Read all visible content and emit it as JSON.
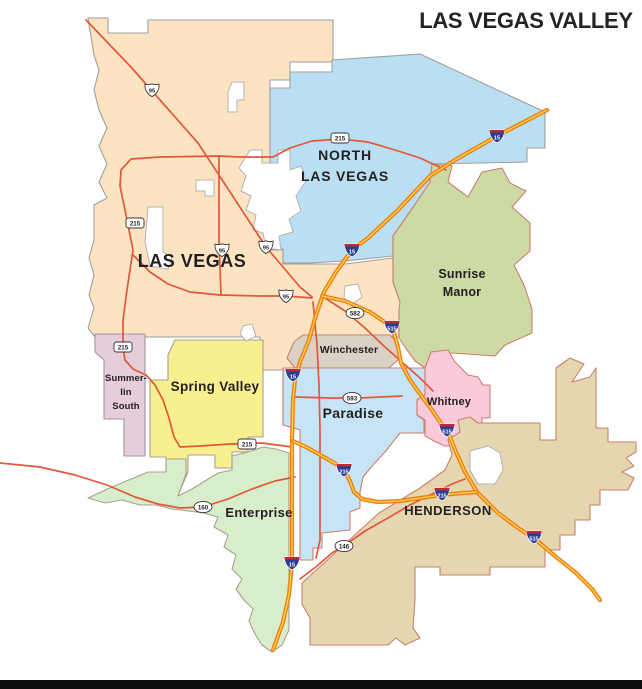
{
  "title": "LAS VEGAS VALLEY",
  "title_color": "#262223",
  "footer": {
    "bar_color": "#0d0d0d"
  },
  "map": {
    "background": "#ffffff",
    "colors": {
      "road": "#e2573b",
      "interstate_outer": "#ee7f1f",
      "interstate_center": "#ffd83c",
      "hole_fill": "#ffffff",
      "hole_stroke": "#b3b3b3",
      "shield_blue": "#2a3f92",
      "shield_red": "#bf2b32",
      "label": "#231f20"
    },
    "regions": [
      {
        "id": "las-vegas",
        "name": "Las Vegas",
        "fill": "#fce4c3",
        "stroke": "#9f9f9f",
        "shape": "88,18 108,18 108,33 148,33 148,20 333,20 333,62 290,62 290,80 270,80 270,250 283,250 283,264 345,264 393,258 393,282 400,302 417,308 417,337 300,337 300,370 260,370 260,337 95,337 88,328 94,308 89,295 94,275 89,258 94,240 94,205 107,198 99,182 107,164 99,146 107,128 99,110 94,90 99,70 94,55",
        "label": {
          "x": 192,
          "y": 267,
          "size": 18,
          "ls": 0.5,
          "lh": 20,
          "lines": [
            "LAS VEGAS"
          ]
        }
      },
      {
        "id": "north-las-vegas",
        "name": "North Las Vegas",
        "fill": "#badef2",
        "stroke": "#9f9f9f",
        "shape": "270,88 290,88 290,72 332,72 332,60 420,54 545,112 545,148 527,148 527,162 432,164 430,182 414,206 393,236 393,256 345,261 310,263 283,263 283,249 270,249",
        "label": {
          "x": 345,
          "y": 160,
          "size": 14,
          "ls": 0.8,
          "lh": 21,
          "lines": [
            "NORTH",
            "LAS VEGAS"
          ]
        }
      },
      {
        "id": "sunrise-manor",
        "name": "Sunrise Manor",
        "fill": "#cedaa5",
        "stroke": "#c9806c",
        "shape": "393,236 414,206 430,182 432,164 452,166 448,182 468,197 482,172 502,168 510,183 526,191 512,207 530,223 530,251 514,265 524,285 532,309 532,333 505,345 495,356 452,353 431,355 425,368 415,361 405,347 399,338 399,310 400,302 393,282 393,256",
        "label": {
          "x": 462,
          "y": 278,
          "size": 12.5,
          "ls": 0.2,
          "lh": 18,
          "lines": [
            "Sunrise",
            "Manor"
          ]
        }
      },
      {
        "id": "winchester",
        "name": "Winchester",
        "fill": "#dbd2c7",
        "stroke": "#c9806c",
        "shape": "303,335 390,335 399,345 399,359 389,368 295,368 287,358 294,342",
        "label": {
          "x": 349,
          "y": 353,
          "size": 10.5,
          "ls": 0.2,
          "lh": 12,
          "lines": [
            "Winchester"
          ]
        }
      },
      {
        "id": "summerlin-south",
        "name": "Summerlin South",
        "fill": "#e5cdda",
        "stroke": "#a096a0",
        "shape": "95,334 145,334 145,456 124,456 124,419 104,419 104,360 95,352",
        "label": {
          "x": 126,
          "y": 381,
          "size": 9.5,
          "ls": 0.1,
          "lh": 14,
          "lines": [
            "Summer-",
            "lin",
            "South"
          ]
        }
      },
      {
        "id": "spring-valley",
        "name": "Spring Valley",
        "fill": "#f8f08e",
        "stroke": "#a8a08f",
        "shape": "175,340 263,340 263,437 248,437 248,452 232,452 232,468 215,468 215,455 188,455 188,472 178,495 166,495 166,457 150,457 150,380 168,380 168,355",
        "label": {
          "x": 215,
          "y": 391,
          "size": 13.5,
          "ls": 0.3,
          "lh": 15,
          "lines": [
            "Spring Valley"
          ]
        }
      },
      {
        "id": "paradise",
        "name": "Paradise",
        "fill": "#c7e4f7",
        "stroke": "#c9806c",
        "shape": "283,368 425,368 425,395 417,400 417,415 424,420 424,433 400,433 385,452 373,465 363,477 360,492 360,508 350,512 350,530 322,533 322,548 313,548 313,560 300,560 300,430 283,425",
        "label": {
          "x": 353,
          "y": 418,
          "size": 14,
          "ls": 0.3,
          "lh": 16,
          "lines": [
            "Paradise"
          ]
        }
      },
      {
        "id": "whitney",
        "name": "Whitney",
        "fill": "#f8cadc",
        "stroke": "#c9806c",
        "shape": "425,368 431,352 448,350 455,362 468,375 478,377 483,385 490,385 490,418 482,418 482,428 472,428 470,440 458,446 445,446 434,441 425,436 425,420 417,415 417,400 425,395",
        "label": {
          "x": 449,
          "y": 405,
          "size": 11,
          "ls": 0.2,
          "lh": 13,
          "lines": [
            "Whitney"
          ]
        }
      },
      {
        "id": "enterprise",
        "name": "Enterprise",
        "fill": "#d8eeca",
        "stroke": "#a8a08f",
        "shape": "88,498 112,487 148,472 166,472 166,459 186,459 186,474 178,496 192,489 205,481 218,473 232,470 232,456 248,452 263,447 276,449 289,453 289,630 282,645 272,652 262,645 255,634 249,621 253,609 243,599 236,589 242,579 232,569 236,555 224,547 228,535 214,527 218,517 204,513 188,511 172,509 156,505 140,505 122,500 105,503",
        "label": {
          "x": 259,
          "y": 517,
          "size": 13,
          "ls": 0.3,
          "lh": 15,
          "lines": [
            "Enterprise"
          ]
        }
      },
      {
        "id": "henderson",
        "name": "Henderson",
        "fill": "#e5d6b0",
        "stroke": "#c9806c",
        "shape": "302,583 379,513 420,488 445,470 452,455 448,440 460,432 458,420 470,417 478,423 540,423 540,440 556,440 556,368 570,358 584,364 572,382 590,377 596,368 596,428 608,428 608,442 636,442 636,452 626,458 634,466 622,472 634,478 628,490 600,490 600,505 590,505 590,520 575,520 575,535 560,535 560,550 545,550 545,567 490,567 490,575 440,575 440,567 415,567 415,600 413,628 420,638 405,645 396,638 388,645 310,645 310,618 302,604",
        "label": {
          "x": 448,
          "y": 515,
          "size": 13,
          "ls": 0.5,
          "lh": 15,
          "lines": [
            "HENDERSON"
          ]
        }
      }
    ],
    "holes": [
      {
        "id": "hole-1",
        "shape": "148,207 163,207 163,252 172,257 168,269 150,266 145,241"
      },
      {
        "id": "hole-2",
        "shape": "250,150 262,150 262,163 278,163 278,150 290,150 290,170 301,166 306,181 296,196 301,211 289,219 293,232 279,236 281,250 266,248 263,233 253,230 256,215 246,210 251,196 241,191 246,176 239,168"
      },
      {
        "id": "hole-3",
        "shape": "232,82 244,82 244,100 237,100 237,112 228,112 228,92"
      },
      {
        "id": "hole-4",
        "shape": "196,180 214,180 214,196 205,196 205,191 196,191"
      },
      {
        "id": "hole-5",
        "shape": "345,286 358,284 362,297 352,304 344,298"
      },
      {
        "id": "hole-6",
        "shape": "470,451 488,446 500,453 503,470 495,484 478,484 470,470"
      },
      {
        "id": "hole-7",
        "shape": "243,326 252,324 256,336 246,341 240,334"
      }
    ],
    "roads": [
      {
        "id": "us95-diagonal",
        "type": "highway",
        "points": "86,20 130,66 198,143 266,247 300,287 312,297"
      },
      {
        "id": "mlk-connector",
        "type": "highway",
        "points": "219,157 219,240 220,268 221,295"
      },
      {
        "id": "beltway-215",
        "type": "highway",
        "points": "446,170 420,158 395,150 368,142 340,139 312,141 290,148 273,157 240,157 219,156 160,157 131,159 121,170 120,186 126,215 133,250 127,290 123,320 123,347 125,360 133,369 146,375 155,385 163,400 169,418 174,437 180,447 200,446 230,444 262,443 292,447"
      },
      {
        "id": "charleston",
        "type": "highway",
        "points": "133,255 150,272 168,284 190,292 220,295 260,296 287,296 312,298"
      },
      {
        "id": "sr-160",
        "type": "highway",
        "points": "0,463 40,467 75,475 107,485 135,497 158,504 180,508 203,507 228,499 252,489 275,481 295,477"
      },
      {
        "id": "sr-146",
        "type": "highway",
        "points": "300,579 317,566 332,553 345,545 365,531 388,518 410,505 432,494 452,484 465,479"
      },
      {
        "id": "sr-593",
        "type": "highway",
        "points": "295,397 330,398 360,398 402,396"
      },
      {
        "id": "sr-582",
        "type": "highway",
        "points": "325,298 345,311 365,328 385,347 403,363 420,378 433,391"
      },
      {
        "id": "las-vegas-blvd",
        "type": "highway",
        "points": "313,302 317,345 319,385 320,430 320,540 316,558"
      },
      {
        "id": "i-15",
        "type": "interstate",
        "points": "547,110 497,136 455,160 430,176 398,210 368,238 352,250 336,272 324,292 316,315 309,340 300,362 295,380 293,400 292,440 292,500 292,540 292,563 289,595 283,622 273,650"
      },
      {
        "id": "i-515",
        "type": "interstate",
        "points": "322,296 345,301 370,312 392,327 398,347 401,363 410,380 420,394 432,410 440,422 448,432 456,452 465,472 477,492 498,513 518,528 534,538 556,557 575,572 592,589 600,600"
      },
      {
        "id": "i-215",
        "type": "interstate",
        "points": "293,441 308,448 322,456 336,464 344,470 350,481 354,492 362,499 378,502 400,501 420,498 442,495 462,493 477,492"
      }
    ],
    "shields": [
      {
        "type": "us",
        "label": "95",
        "x": 152,
        "y": 90
      },
      {
        "type": "us",
        "label": "95",
        "x": 222,
        "y": 250
      },
      {
        "type": "us",
        "label": "95",
        "x": 266,
        "y": 247
      },
      {
        "type": "us",
        "label": "95",
        "x": 286,
        "y": 296
      },
      {
        "type": "rect",
        "label": "215",
        "x": 135,
        "y": 223
      },
      {
        "type": "rect",
        "label": "215",
        "x": 340,
        "y": 138
      },
      {
        "type": "rect",
        "label": "215",
        "x": 123,
        "y": 347
      },
      {
        "type": "rect",
        "label": "215",
        "x": 247,
        "y": 444
      },
      {
        "type": "oval",
        "label": "582",
        "x": 355,
        "y": 313
      },
      {
        "type": "oval",
        "label": "593",
        "x": 352,
        "y": 398
      },
      {
        "type": "oval",
        "label": "160",
        "x": 203,
        "y": 507
      },
      {
        "type": "oval",
        "label": "146",
        "x": 344,
        "y": 546
      },
      {
        "type": "interstate",
        "label": "15",
        "x": 497,
        "y": 136
      },
      {
        "type": "interstate",
        "label": "15",
        "x": 352,
        "y": 250
      },
      {
        "type": "interstate",
        "label": "15",
        "x": 293,
        "y": 375
      },
      {
        "type": "interstate",
        "label": "15",
        "x": 292,
        "y": 563
      },
      {
        "type": "interstate",
        "label": "515",
        "x": 392,
        "y": 327
      },
      {
        "type": "interstate",
        "label": "515",
        "x": 447,
        "y": 430
      },
      {
        "type": "interstate",
        "label": "515",
        "x": 534,
        "y": 537
      },
      {
        "type": "interstate",
        "label": "215",
        "x": 344,
        "y": 470
      },
      {
        "type": "interstate",
        "label": "215",
        "x": 442,
        "y": 494
      }
    ]
  }
}
